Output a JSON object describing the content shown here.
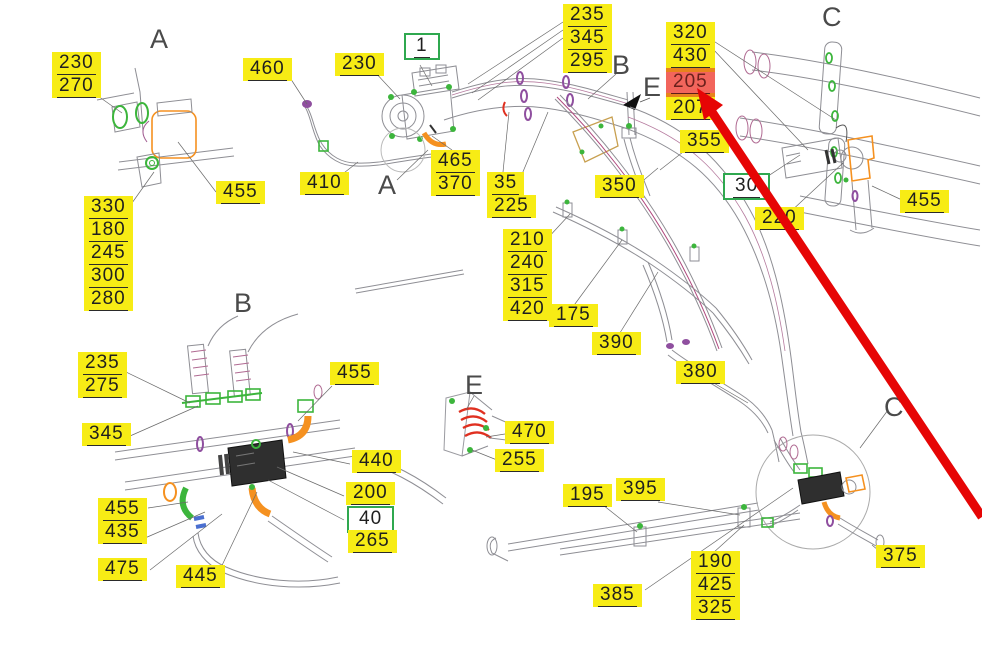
{
  "diagram": {
    "kind": "technical-parts-diagram",
    "background": "#ffffff"
  },
  "colors": {
    "label_bg": "#f7ec15",
    "label_text": "#1f1f1f",
    "green_box": "#2fa84f",
    "highlight_bg": "#f2655c",
    "highlight_band": "#e8831c",
    "highlight_text": "#6b201b",
    "arrow_red": "#e60505",
    "letter_color": "#4a4a4a"
  },
  "section_letters": [
    {
      "char": "A",
      "x": 150,
      "y": 26
    },
    {
      "char": "B",
      "x": 612,
      "y": 52
    },
    {
      "char": "E",
      "x": 643,
      "y": 74
    },
    {
      "char": "C",
      "x": 822,
      "y": 4
    },
    {
      "char": "A",
      "x": 378,
      "y": 172
    },
    {
      "char": "B",
      "x": 234,
      "y": 290
    },
    {
      "char": "E",
      "x": 465,
      "y": 372
    },
    {
      "char": "C",
      "x": 884,
      "y": 394
    }
  ],
  "labels": [
    {
      "name": "label-230-270",
      "x": 52,
      "y": 52,
      "lines": [
        "230",
        "270"
      ]
    },
    {
      "name": "label-460",
      "x": 243,
      "y": 58,
      "lines": [
        "460"
      ]
    },
    {
      "name": "label-410",
      "x": 300,
      "y": 172,
      "lines": [
        "410"
      ]
    },
    {
      "name": "label-455-a",
      "x": 216,
      "y": 181,
      "lines": [
        "455"
      ]
    },
    {
      "name": "label-330-180-245-300-280",
      "x": 84,
      "y": 196,
      "lines": [
        "330",
        "180",
        "245",
        "300",
        "280"
      ]
    },
    {
      "name": "label-230-compressor",
      "x": 335,
      "y": 53,
      "lines": [
        "230"
      ]
    },
    {
      "name": "label-1",
      "x": 404,
      "y": 33,
      "lines": [
        "1"
      ],
      "box": "green"
    },
    {
      "name": "label-235-345-295",
      "x": 563,
      "y": 4,
      "lines": [
        "235",
        "345",
        "295"
      ]
    },
    {
      "name": "label-465-370",
      "x": 431,
      "y": 150,
      "lines": [
        "465",
        "370"
      ]
    },
    {
      "name": "label-35-225",
      "x": 487,
      "y": 172,
      "lines": [
        "35",
        "225"
      ]
    },
    {
      "name": "label-350",
      "x": 595,
      "y": 175,
      "lines": [
        "350"
      ]
    },
    {
      "name": "label-355",
      "x": 680,
      "y": 130,
      "lines": [
        "355"
      ]
    },
    {
      "name": "label-320-430-205-207",
      "x": 666,
      "y": 22,
      "lines": [
        "320",
        "430",
        "205",
        "207"
      ],
      "highlight_index": 2
    },
    {
      "name": "label-30",
      "x": 723,
      "y": 173,
      "lines": [
        "30"
      ],
      "box": "green"
    },
    {
      "name": "label-220",
      "x": 755,
      "y": 207,
      "lines": [
        "220"
      ]
    },
    {
      "name": "label-455-c",
      "x": 900,
      "y": 190,
      "lines": [
        "455"
      ]
    },
    {
      "name": "label-210-240-315-420",
      "x": 503,
      "y": 229,
      "lines": [
        "210",
        "240",
        "315",
        "420"
      ]
    },
    {
      "name": "label-175",
      "x": 549,
      "y": 304,
      "lines": [
        "175"
      ]
    },
    {
      "name": "label-390",
      "x": 592,
      "y": 332,
      "lines": [
        "390"
      ]
    },
    {
      "name": "label-380",
      "x": 676,
      "y": 361,
      "lines": [
        "380"
      ]
    },
    {
      "name": "label-235-275",
      "x": 78,
      "y": 352,
      "lines": [
        "235",
        "275"
      ]
    },
    {
      "name": "label-345-b",
      "x": 82,
      "y": 423,
      "lines": [
        "345"
      ]
    },
    {
      "name": "label-455-b1",
      "x": 330,
      "y": 362,
      "lines": [
        "455"
      ]
    },
    {
      "name": "label-440",
      "x": 352,
      "y": 450,
      "lines": [
        "440"
      ]
    },
    {
      "name": "label-200",
      "x": 346,
      "y": 482,
      "lines": [
        "200"
      ]
    },
    {
      "name": "label-40",
      "x": 347,
      "y": 506,
      "lines": [
        "40"
      ],
      "box": "green"
    },
    {
      "name": "label-265",
      "x": 348,
      "y": 530,
      "lines": [
        "265"
      ]
    },
    {
      "name": "label-455-435",
      "x": 98,
      "y": 498,
      "lines": [
        "455",
        "435"
      ]
    },
    {
      "name": "label-475",
      "x": 98,
      "y": 558,
      "lines": [
        "475"
      ]
    },
    {
      "name": "label-445",
      "x": 176,
      "y": 565,
      "lines": [
        "445"
      ]
    },
    {
      "name": "label-470",
      "x": 505,
      "y": 421,
      "lines": [
        "470"
      ]
    },
    {
      "name": "label-255",
      "x": 495,
      "y": 449,
      "lines": [
        "255"
      ]
    },
    {
      "name": "label-195",
      "x": 563,
      "y": 484,
      "lines": [
        "195"
      ]
    },
    {
      "name": "label-395",
      "x": 616,
      "y": 478,
      "lines": [
        "395"
      ]
    },
    {
      "name": "label-385",
      "x": 593,
      "y": 584,
      "lines": [
        "385"
      ]
    },
    {
      "name": "label-190-425-325",
      "x": 691,
      "y": 551,
      "lines": [
        "190",
        "425",
        "325"
      ]
    },
    {
      "name": "label-375",
      "x": 876,
      "y": 545,
      "lines": [
        "375"
      ]
    }
  ],
  "highlight": {
    "value": "205"
  },
  "arrow": {
    "color": "#e60505",
    "line": {
      "x1": 982,
      "y1": 517,
      "x2": 708,
      "y2": 106
    },
    "head_points": "697,88 723,105 704,120"
  }
}
